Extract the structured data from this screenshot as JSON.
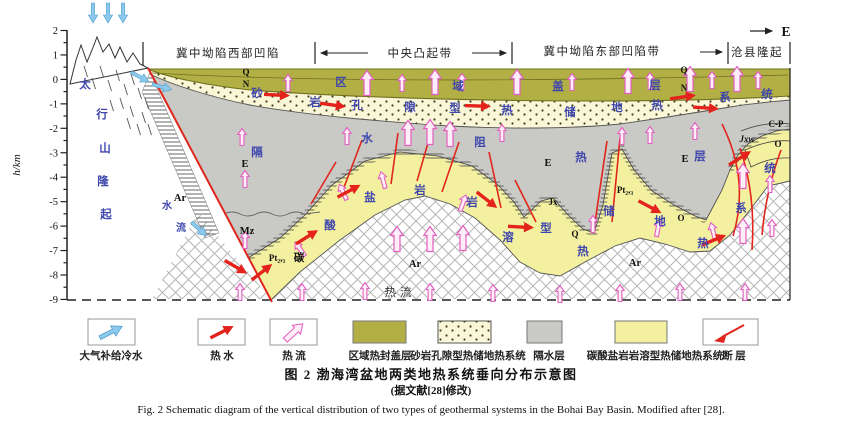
{
  "figure": {
    "caption_zh": "图 2  渤海湾盆地两类地热系统垂向分布示意图",
    "caption_note": "(据文献[28]修改)",
    "caption_en": "Fig. 2  Schematic diagram of the vertical distribution of two types of geothermal systems in the Bohai Bay Basin. Modified after [28]."
  },
  "compass": {
    "east": "E"
  },
  "axis": {
    "label": "h/km",
    "ticks": [
      "2",
      "1",
      "0",
      "-1",
      "-2",
      "-3",
      "-4",
      "-5",
      "-6",
      "-7",
      "-8",
      "-9"
    ]
  },
  "header": {
    "zones": [
      {
        "label": "冀中坳陷西部凹陷"
      },
      {
        "label": "中央凸起带"
      },
      {
        "label": "冀中坳陷东部凹陷带"
      },
      {
        "label": "沧县隆起"
      }
    ]
  },
  "legend": {
    "items": [
      {
        "label": "大气补给冷水",
        "icon": "cold-water-arrow"
      },
      {
        "label": "热  水",
        "icon": "hot-water-arrow"
      },
      {
        "label": "热  流",
        "icon": "heat-flow-arrow"
      },
      {
        "label": "区域热封盖层",
        "icon": "cap-layer-swatch",
        "color": "#b2b044"
      },
      {
        "label": "砂岩孔隙型热储地热系统",
        "icon": "sandstone-swatch",
        "color": "#faf6d8"
      },
      {
        "label": "隔水层",
        "icon": "aquiclude-swatch",
        "color": "#c9c9c5"
      },
      {
        "label": "碳酸盐岩岩溶型热储地热系统",
        "icon": "carbonate-swatch",
        "color": "#f3f0a0"
      },
      {
        "label": "断  层",
        "icon": "fault-line"
      }
    ]
  },
  "annotations": {
    "labels": [
      {
        "t": "太",
        "x": 85,
        "y": 88,
        "c": "b"
      },
      {
        "t": "行",
        "x": 102,
        "y": 118,
        "c": "b"
      },
      {
        "t": "山",
        "x": 105,
        "y": 152,
        "c": "b"
      },
      {
        "t": "隆",
        "x": 103,
        "y": 185,
        "c": "b"
      },
      {
        "t": "起",
        "x": 106,
        "y": 218,
        "c": "b"
      },
      {
        "t": "水",
        "x": 167,
        "y": 209,
        "c": "bs"
      },
      {
        "t": "流",
        "x": 181,
        "y": 231,
        "c": "bs"
      },
      {
        "t": "区",
        "x": 341,
        "y": 86,
        "c": "b"
      },
      {
        "t": "域",
        "x": 458,
        "y": 90,
        "c": "b"
      },
      {
        "t": "盖",
        "x": 558,
        "y": 90,
        "c": "b"
      },
      {
        "t": "层",
        "x": 655,
        "y": 89,
        "c": "b"
      },
      {
        "t": "Q",
        "x": 246,
        "y": 75,
        "c": "u"
      },
      {
        "t": "N",
        "x": 246,
        "y": 87,
        "c": "u"
      },
      {
        "t": "Q",
        "x": 684,
        "y": 73,
        "c": "u"
      },
      {
        "t": "N",
        "x": 684,
        "y": 91,
        "c": "u"
      },
      {
        "t": "砂",
        "x": 257,
        "y": 97,
        "c": "b"
      },
      {
        "t": "岩",
        "x": 315,
        "y": 106,
        "c": "b"
      },
      {
        "t": "孔",
        "x": 357,
        "y": 109,
        "c": "b"
      },
      {
        "t": "隙",
        "x": 410,
        "y": 111,
        "c": "b"
      },
      {
        "t": "型",
        "x": 455,
        "y": 112,
        "c": "b"
      },
      {
        "t": "热",
        "x": 507,
        "y": 114,
        "c": "b"
      },
      {
        "t": "储",
        "x": 570,
        "y": 116,
        "c": "b"
      },
      {
        "t": "地",
        "x": 617,
        "y": 111,
        "c": "b"
      },
      {
        "t": "热",
        "x": 657,
        "y": 109,
        "c": "b"
      },
      {
        "t": "系",
        "x": 725,
        "y": 101,
        "c": "b"
      },
      {
        "t": "统",
        "x": 767,
        "y": 98,
        "c": "b"
      },
      {
        "t": "隔",
        "x": 257,
        "y": 156,
        "c": "b"
      },
      {
        "t": "水",
        "x": 367,
        "y": 142,
        "c": "b"
      },
      {
        "t": "阻",
        "x": 480,
        "y": 146,
        "c": "b"
      },
      {
        "t": "热",
        "x": 581,
        "y": 161,
        "c": "b"
      },
      {
        "t": "层",
        "x": 700,
        "y": 160,
        "c": "b"
      },
      {
        "t": "E",
        "x": 245,
        "y": 167,
        "c": "k"
      },
      {
        "t": "E",
        "x": 548,
        "y": 166,
        "c": "k"
      },
      {
        "t": "E",
        "x": 685,
        "y": 162,
        "c": "k"
      },
      {
        "t": "Mz",
        "x": 247,
        "y": 234,
        "c": "k"
      },
      {
        "t": "酸",
        "x": 330,
        "y": 229,
        "c": "b"
      },
      {
        "t": "盐",
        "x": 370,
        "y": 201,
        "c": "b"
      },
      {
        "t": "岩",
        "x": 420,
        "y": 194,
        "c": "b"
      },
      {
        "t": "岩",
        "x": 472,
        "y": 206,
        "c": "b"
      },
      {
        "t": "溶",
        "x": 508,
        "y": 241,
        "c": "b"
      },
      {
        "t": "型",
        "x": 546,
        "y": 232,
        "c": "b"
      },
      {
        "t": "热",
        "x": 583,
        "y": 255,
        "c": "b"
      },
      {
        "t": "储",
        "x": 609,
        "y": 215,
        "c": "b"
      },
      {
        "t": "地",
        "x": 660,
        "y": 225,
        "c": "b"
      },
      {
        "t": "热",
        "x": 703,
        "y": 247,
        "c": "b"
      },
      {
        "t": "系",
        "x": 741,
        "y": 212,
        "c": "b"
      },
      {
        "t": "统",
        "x": 770,
        "y": 172,
        "c": "b"
      },
      {
        "t": "碳",
        "x": 299,
        "y": 261,
        "c": "k"
      },
      {
        "t": "Pt₂,₃",
        "x": 277,
        "y": 261,
        "c": "u"
      },
      {
        "t": "Pt₂,₃",
        "x": 625,
        "y": 193,
        "c": "u"
      },
      {
        "t": "Jx",
        "x": 553,
        "y": 205,
        "c": "u"
      },
      {
        "t": "Q",
        "x": 575,
        "y": 237,
        "c": "u"
      },
      {
        "t": "O",
        "x": 681,
        "y": 221,
        "c": "u"
      },
      {
        "t": "C-P",
        "x": 776,
        "y": 127,
        "c": "u"
      },
      {
        "t": "Jxw",
        "x": 747,
        "y": 142,
        "c": "ui"
      },
      {
        "t": "O",
        "x": 778,
        "y": 147,
        "c": "u"
      },
      {
        "t": "Ar",
        "x": 180,
        "y": 201,
        "c": "k"
      },
      {
        "t": "Ar",
        "x": 415,
        "y": 267,
        "c": "k"
      },
      {
        "t": "Ar",
        "x": 635,
        "y": 266,
        "c": "k"
      },
      {
        "t": "热流",
        "x": 400,
        "y": 296,
        "c": "d"
      }
    ]
  },
  "colors": {
    "cap_layer": "#b2b044",
    "cap_border": "#6f6f1e",
    "sandstone": "#faf6d8",
    "aquiclude_gray": "#c9c9c5",
    "carbonate": "#f3f0a0",
    "hot_water_red": "#e3231c",
    "heat_flow_pink": "#e35fc0",
    "cold_water_blue": "#8cc9ec",
    "label_blue": "#3f47ac",
    "fault_red": "#e0261d"
  }
}
